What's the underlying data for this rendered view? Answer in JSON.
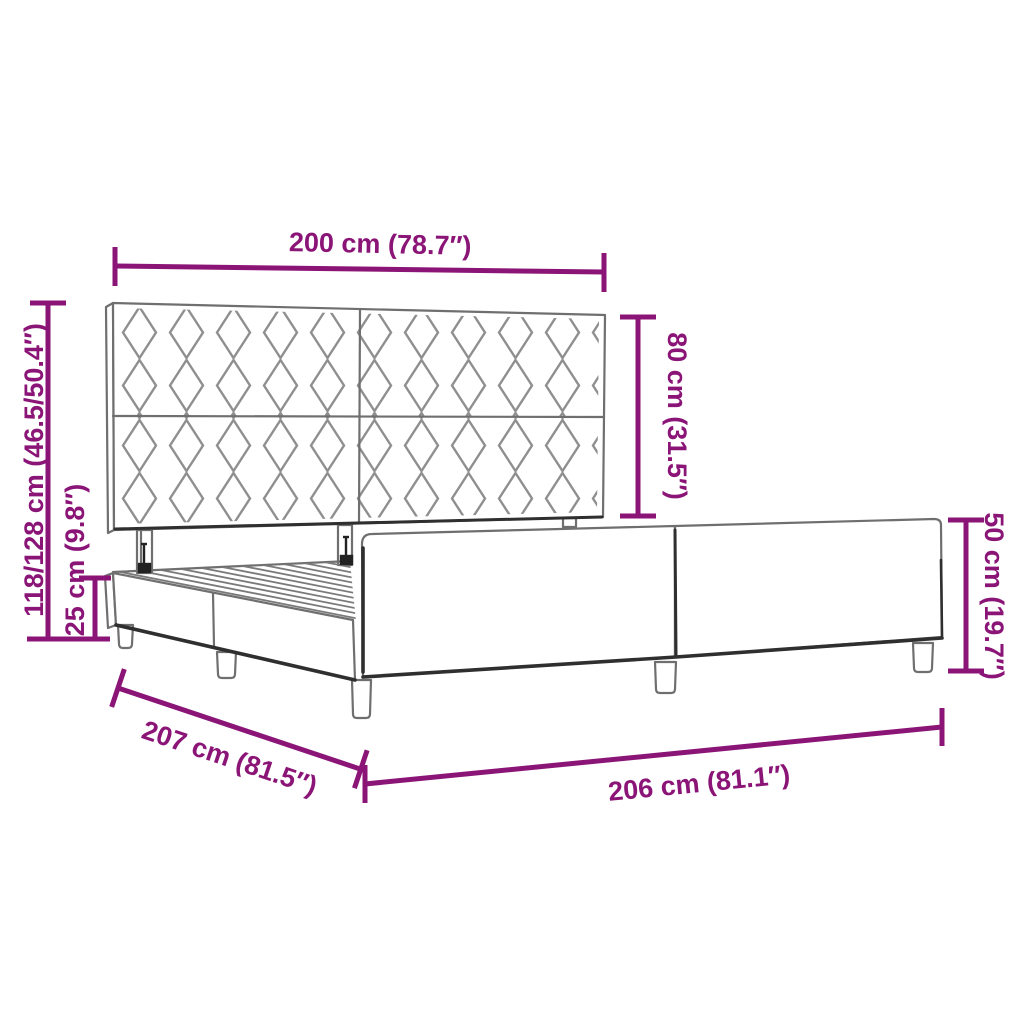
{
  "diagram": {
    "subject": "bed-frame-with-headboard-dimension-diagram",
    "dims": {
      "headboard_width": "200 cm (78.7″)",
      "headboard_panel_height": "80 cm (31.5″)",
      "overall_height_range": "118/128 cm (46.5/50.4″)",
      "base_frame_height": "25 cm (9.8″)",
      "side_rail_height": "50 cm (19.7″)",
      "overall_length": "207 cm (81.5″)",
      "frame_length": "206 cm (81.1″)"
    },
    "colors": {
      "background": "#ffffff",
      "accent": "#8B1577",
      "line": "#6f6f6f",
      "dark": "#2f2f2f",
      "pattern": "#8f8f8f",
      "slat": "#7a7a7a",
      "bolt": "#222222"
    }
  }
}
